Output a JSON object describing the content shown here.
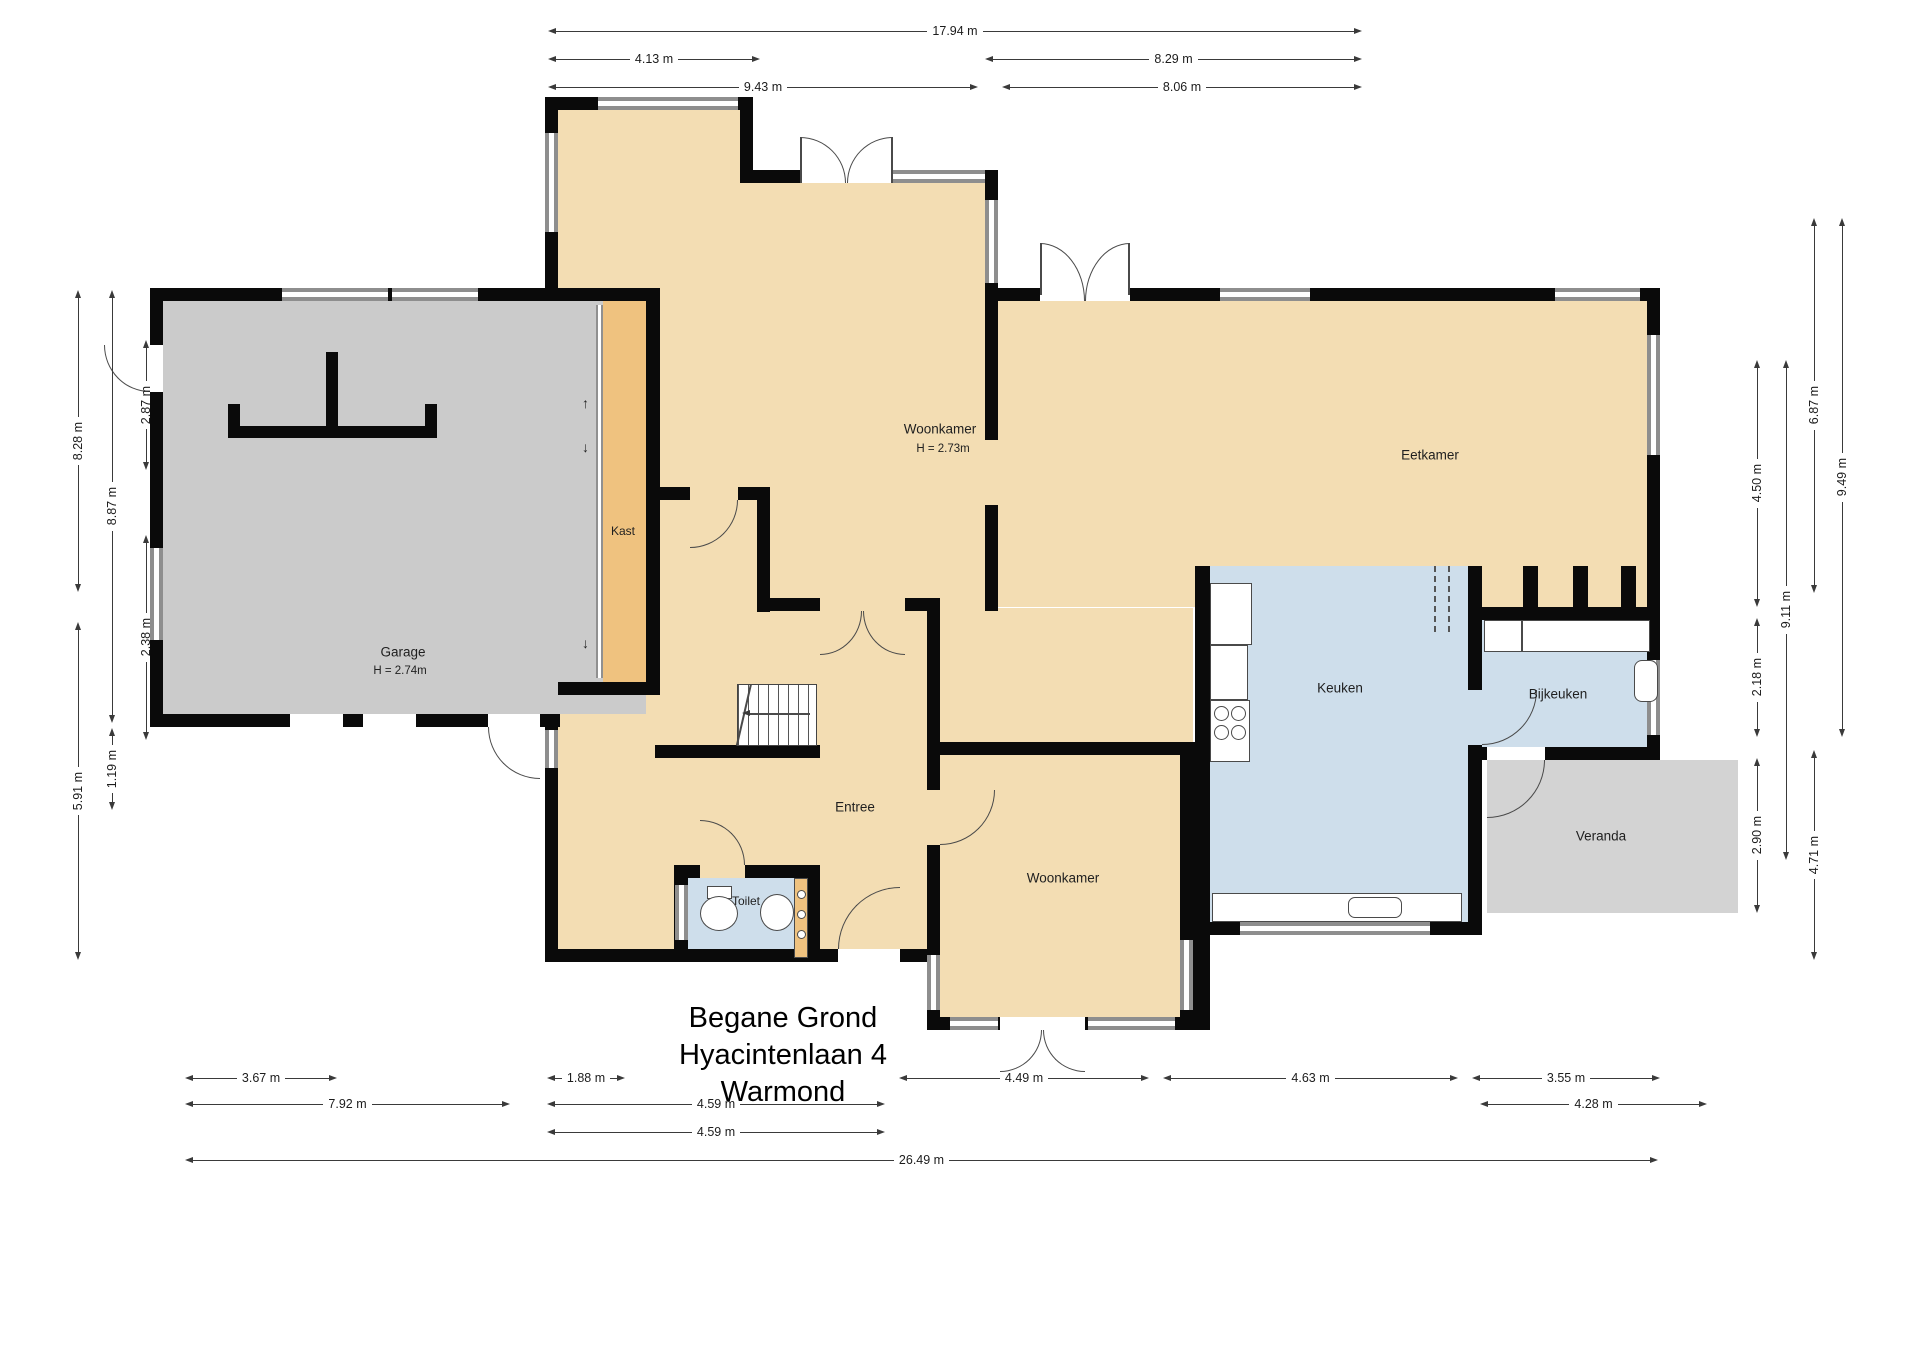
{
  "title": {
    "line1": "Begane Grond",
    "line2": "Hyacintenlaan 4",
    "line3": "Warmond"
  },
  "rooms": {
    "woonkamer_top": {
      "name": "Woonkamer",
      "height": "H = 2.73m"
    },
    "garage": {
      "name": "Garage",
      "height": "H = 2.74m"
    },
    "kast": {
      "name": "Kast"
    },
    "entree": {
      "name": "Entree"
    },
    "toilet": {
      "name": "Toilet"
    },
    "woonkamer_bottom": {
      "name": "Woonkamer"
    },
    "eetkamer": {
      "name": "Eetkamer"
    },
    "keuken": {
      "name": "Keuken"
    },
    "bijkeuken": {
      "name": "Bijkeuken"
    },
    "veranda": {
      "name": "Veranda"
    }
  },
  "dimensions": {
    "top": [
      "17.94 m",
      "4.13 m",
      "8.29 m",
      "9.43 m",
      "8.06 m"
    ],
    "left": [
      "8.28 m",
      "2.87 m",
      "8.87 m",
      "2.38 m",
      "5.91 m",
      "1.19 m"
    ],
    "right": [
      "6.87 m",
      "9.49 m",
      "4.50 m",
      "9.11 m",
      "2.18 m",
      "2.90 m",
      "4.71 m"
    ],
    "bottom": [
      "3.67 m",
      "1.88 m",
      "4.49 m",
      "4.63 m",
      "3.55 m",
      "7.92 m",
      "4.59 m",
      "4.28 m",
      "4.59 m",
      "26.49 m"
    ]
  },
  "colors": {
    "room_fill": "#F3DDB3",
    "closet_fill": "#EFC27F",
    "garage_fill": "#CBCBCB",
    "veranda_fill": "#D3D3D3",
    "wet_room_fill": "#CEDEEB",
    "wall": "#0A0A0A",
    "window": "#8E8E8E",
    "dimension_line": "#3A3A3A"
  }
}
